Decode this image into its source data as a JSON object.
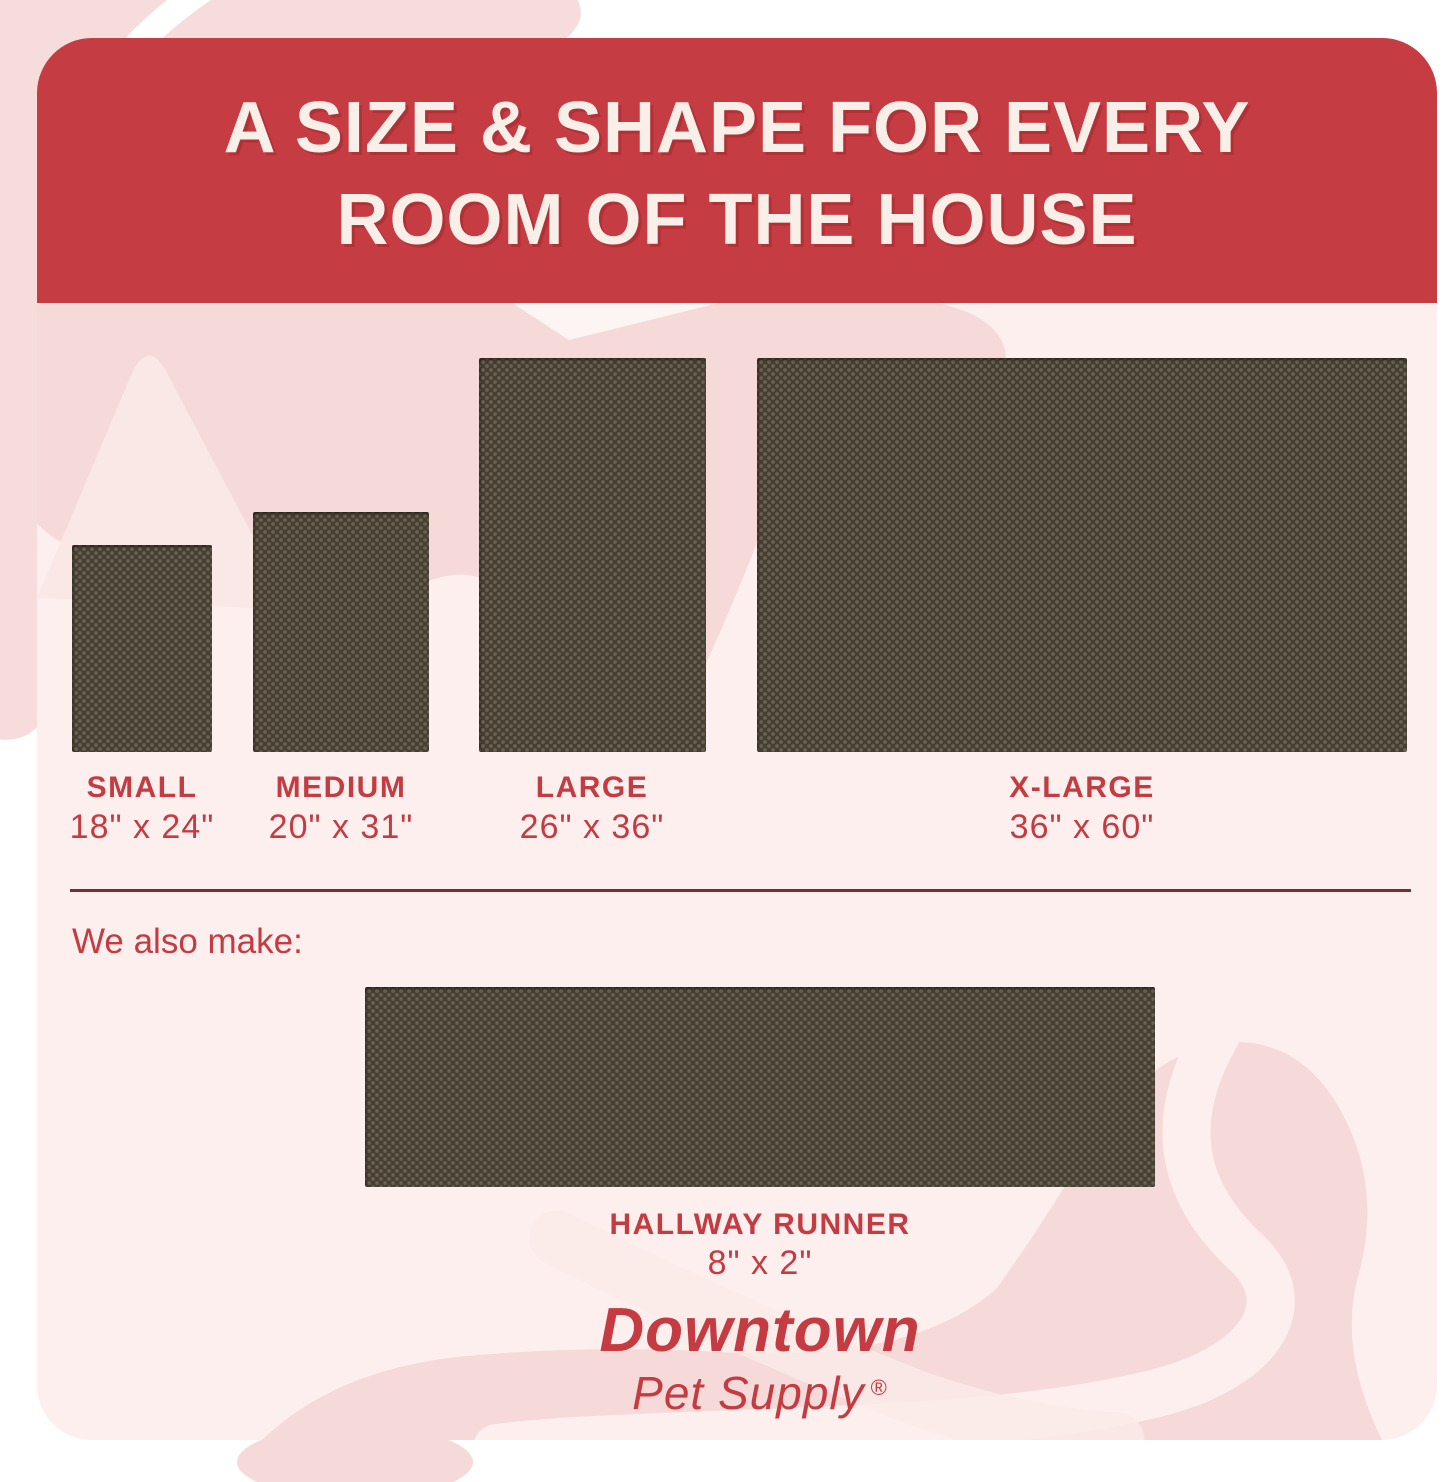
{
  "header": {
    "title_line1": "A SIZE & SHAPE FOR EVERY",
    "title_line2": "ROOM OF THE HOUSE"
  },
  "sizes": [
    {
      "name": "SMALL",
      "dims": "18\" x 24\""
    },
    {
      "name": "MEDIUM",
      "dims": "20\" x 31\""
    },
    {
      "name": "LARGE",
      "dims": "26\" x 36\""
    },
    {
      "name": "X-LARGE",
      "dims": "36\" x 60\""
    }
  ],
  "also_make_label": "We also make:",
  "runner": {
    "name": "HALLWAY RUNNER",
    "dims": "8\" x 2\""
  },
  "brand": {
    "primary": "Downtown",
    "secondary": "Pet Supply",
    "registered": "®"
  },
  "colors": {
    "banner_red": "#C53C42",
    "banner_text": "#F8F0E8",
    "label_red": "#C23C42",
    "rug_brown": "#463F34",
    "card_pink": "#FCEFEE",
    "swirl_pink_dark": "#F5DAD9",
    "swirl_pink_mid": "#F9E6E4",
    "divider_maroon": "#7C2D32"
  }
}
